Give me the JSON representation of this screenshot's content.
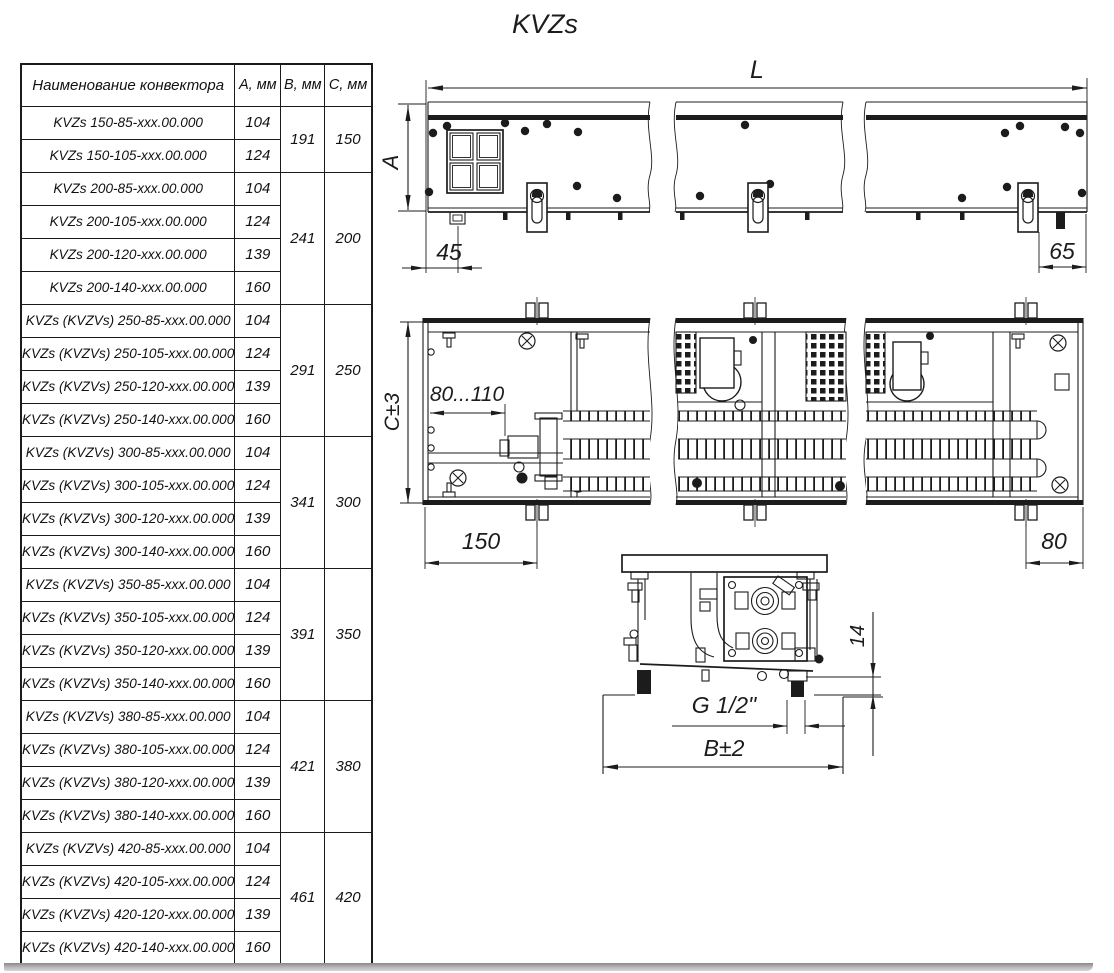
{
  "title": "KVZs",
  "colors": {
    "ink": "#1c1c1c",
    "background": "#ffffff",
    "shadow_bar": "#a6a6a6"
  },
  "table": {
    "headers": {
      "name": "Наименование конвектора",
      "a": "A, мм",
      "b": "B, мм",
      "c": "C, мм"
    },
    "rows": [
      {
        "name": "KVZs 150-85-xxx.00.000",
        "a": "104"
      },
      {
        "name": "KVZs 150-105-xxx.00.000",
        "a": "124"
      },
      {
        "name": "KVZs 200-85-xxx.00.000",
        "a": "104"
      },
      {
        "name": "KVZs 200-105-xxx.00.000",
        "a": "124"
      },
      {
        "name": "KVZs 200-120-xxx.00.000",
        "a": "139"
      },
      {
        "name": "KVZs 200-140-xxx.00.000",
        "a": "160"
      },
      {
        "name": "KVZs (KVZVs) 250-85-xxx.00.000",
        "a": "104"
      },
      {
        "name": "KVZs (KVZVs) 250-105-xxx.00.000",
        "a": "124"
      },
      {
        "name": "KVZs (KVZVs) 250-120-xxx.00.000",
        "a": "139"
      },
      {
        "name": "KVZs (KVZVs) 250-140-xxx.00.000",
        "a": "160"
      },
      {
        "name": "KVZs (KVZVs) 300-85-xxx.00.000",
        "a": "104"
      },
      {
        "name": "KVZs (KVZVs) 300-105-xxx.00.000",
        "a": "124"
      },
      {
        "name": "KVZs (KVZVs) 300-120-xxx.00.000",
        "a": "139"
      },
      {
        "name": "KVZs (KVZVs) 300-140-xxx.00.000",
        "a": "160"
      },
      {
        "name": "KVZs (KVZVs) 350-85-xxx.00.000",
        "a": "104"
      },
      {
        "name": "KVZs (KVZVs) 350-105-xxx.00.000",
        "a": "124"
      },
      {
        "name": "KVZs (KVZVs) 350-120-xxx.00.000",
        "a": "139"
      },
      {
        "name": "KVZs (KVZVs) 350-140-xxx.00.000",
        "a": "160"
      },
      {
        "name": "KVZs (KVZVs) 380-85-xxx.00.000",
        "a": "104"
      },
      {
        "name": "KVZs (KVZVs) 380-105-xxx.00.000",
        "a": "124"
      },
      {
        "name": "KVZs (KVZVs) 380-120-xxx.00.000",
        "a": "139"
      },
      {
        "name": "KVZs (KVZVs) 380-140-xxx.00.000",
        "a": "160"
      },
      {
        "name": "KVZs (KVZVs) 420-85-xxx.00.000",
        "a": "104"
      },
      {
        "name": "KVZs (KVZVs) 420-105-xxx.00.000",
        "a": "124"
      },
      {
        "name": "KVZs (KVZVs) 420-120-xxx.00.000",
        "a": "139"
      },
      {
        "name": "KVZs (KVZVs) 420-140-xxx.00.000",
        "a": "160"
      }
    ],
    "groups": [
      {
        "b": "191",
        "c": "150"
      },
      {
        "b": "241",
        "c": "200"
      },
      {
        "b": "291",
        "c": "250"
      },
      {
        "b": "341",
        "c": "300"
      },
      {
        "b": "391",
        "c": "350"
      },
      {
        "b": "421",
        "c": "380"
      },
      {
        "b": "461",
        "c": "420"
      }
    ]
  },
  "dimensions": {
    "length": "L",
    "height": "A",
    "offset_left": "45",
    "offset_right": "65",
    "depth": "C±3",
    "pipe_range": "80...110",
    "bracket_left": "150",
    "bracket_right": "80",
    "thread": "G 1/2\"",
    "width": "B±2",
    "clearance": "14"
  }
}
